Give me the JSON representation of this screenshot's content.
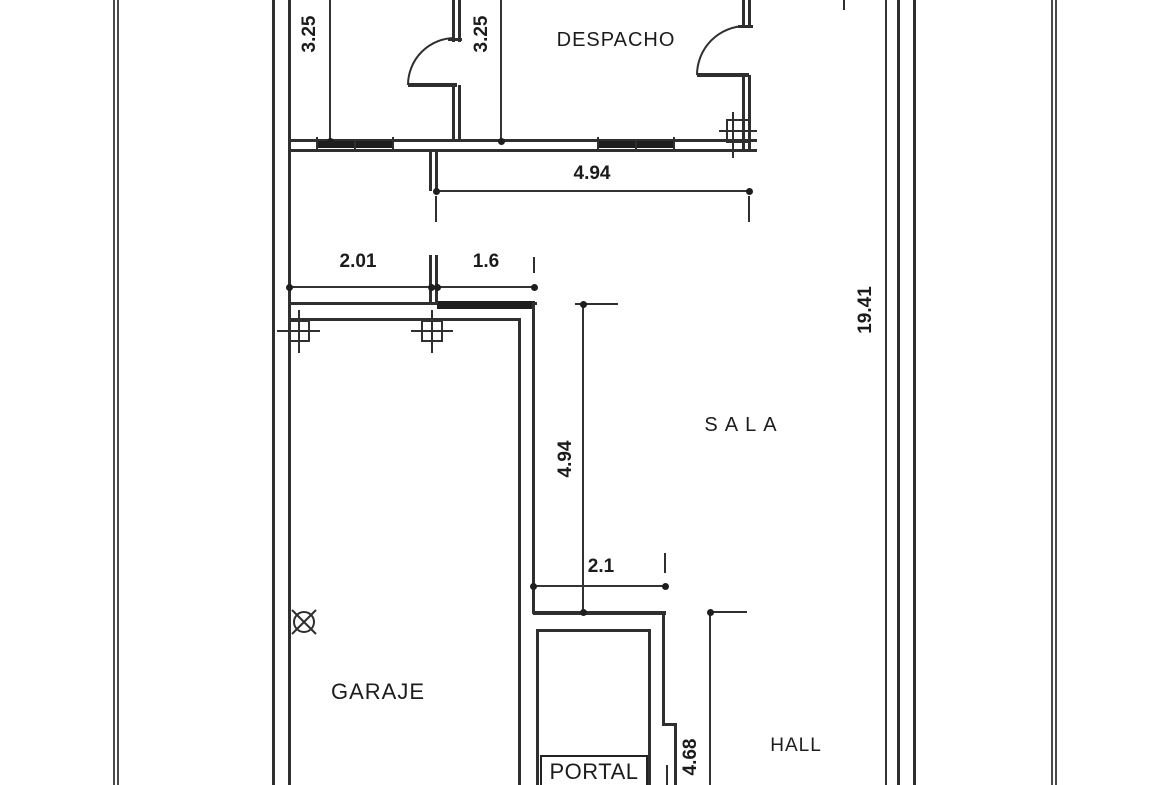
{
  "rooms": {
    "despacho": "DESPACHO",
    "sala": "SALA",
    "garaje": "GARAJE",
    "hall": "HALL",
    "portal": "PORTAL"
  },
  "dimensions": {
    "left_room_depth": "3.25",
    "despacho_depth": "3.25",
    "sala_top_width": "4.94",
    "garage_top_left": "2.01",
    "garage_top_opening": "1.6",
    "plot_length": "19.41",
    "garage_wall_length": "4.94",
    "sala_bottom_opening": "2.1",
    "hall_depth": "4.68"
  },
  "symbols": {
    "door_swings": 2,
    "column_markers": 3,
    "window_markers": 3,
    "drain_marker": 1
  },
  "colors": {
    "wall": "#2f2f2f",
    "dimension_line": "#333333",
    "text": "#1b1b1b",
    "boundary": "#4a4a4a",
    "background": "#ffffff"
  }
}
